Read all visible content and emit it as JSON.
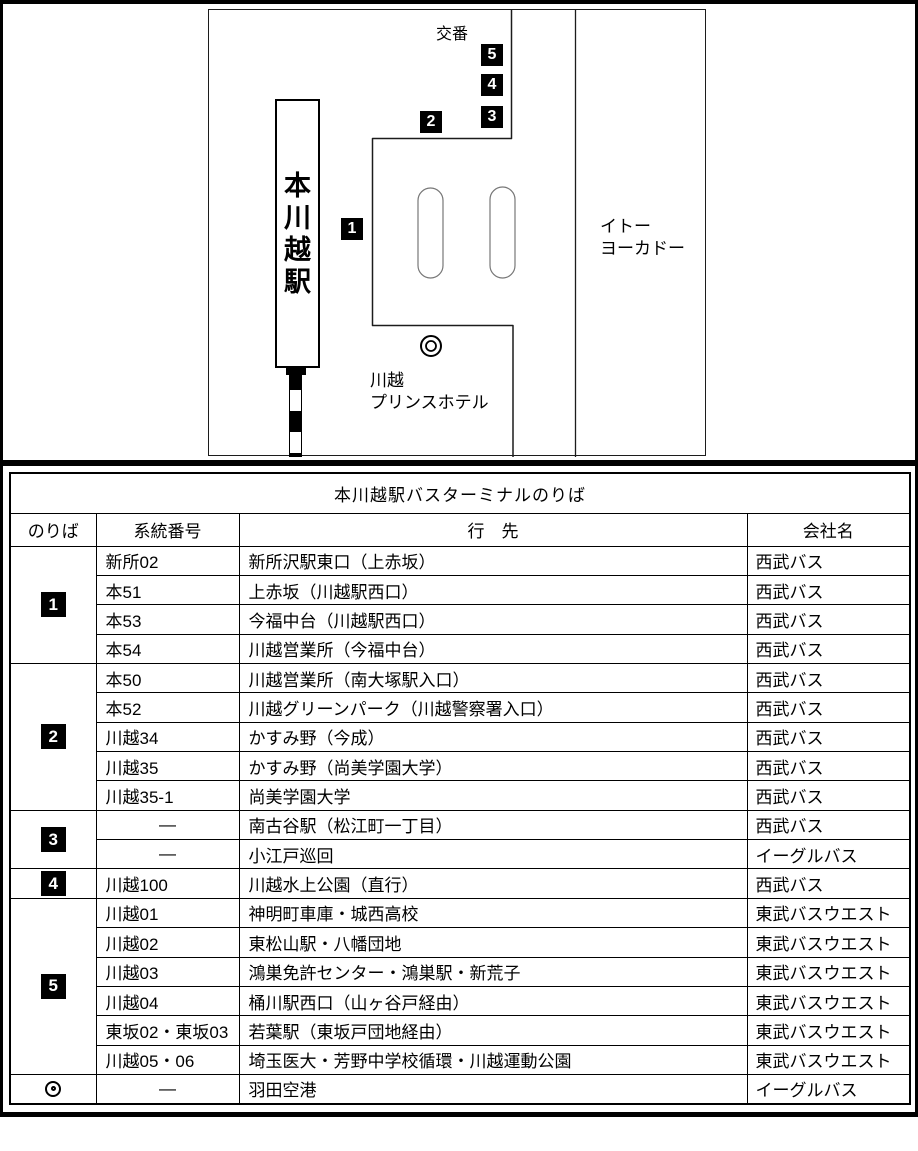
{
  "map": {
    "station": "本川越駅",
    "police_box": "交番",
    "store": [
      "イトー",
      "ヨーカドー"
    ],
    "hotel": [
      "川越",
      "プリンスホテル"
    ],
    "stop_markers": [
      "1",
      "2",
      "3",
      "4",
      "5"
    ]
  },
  "table": {
    "title": "本川越駅バスターミナルのりば",
    "headers": [
      "のりば",
      "系統番号",
      "行　先",
      "会社名"
    ],
    "groups": [
      {
        "platform": "1",
        "marker": "square",
        "rows": [
          {
            "route": "新所02",
            "destination": "新所沢駅東口（上赤坂）",
            "company": "西武バス"
          },
          {
            "route": "本51",
            "destination": "上赤坂（川越駅西口）",
            "company": "西武バス"
          },
          {
            "route": "本53",
            "destination": "今福中台（川越駅西口）",
            "company": "西武バス"
          },
          {
            "route": "本54",
            "destination": "川越営業所（今福中台）",
            "company": "西武バス"
          }
        ]
      },
      {
        "platform": "2",
        "marker": "square",
        "rows": [
          {
            "route": "本50",
            "destination": "川越営業所（南大塚駅入口）",
            "company": "西武バス"
          },
          {
            "route": "本52",
            "destination": "川越グリーンパーク（川越警察署入口）",
            "company": "西武バス"
          },
          {
            "route": "川越34",
            "destination": "かすみ野（今成）",
            "company": "西武バス"
          },
          {
            "route": "川越35",
            "destination": "かすみ野（尚美学園大学）",
            "company": "西武バス"
          },
          {
            "route": "川越35-1",
            "destination": "尚美学園大学",
            "company": "西武バス"
          }
        ]
      },
      {
        "platform": "3",
        "marker": "square",
        "rows": [
          {
            "route": "—",
            "destination": "南古谷駅（松江町一丁目）",
            "company": "西武バス"
          },
          {
            "route": "—",
            "destination": "小江戸巡回",
            "company": "イーグルバス"
          }
        ]
      },
      {
        "platform": "4",
        "marker": "square",
        "rows": [
          {
            "route": "川越100",
            "destination": "川越水上公園（直行）",
            "company": "西武バス"
          }
        ]
      },
      {
        "platform": "5",
        "marker": "square",
        "rows": [
          {
            "route": "川越01",
            "destination": "神明町車庫・城西高校",
            "company": "東武バスウエスト"
          },
          {
            "route": "川越02",
            "destination": "東松山駅・八幡団地",
            "company": "東武バスウエスト"
          },
          {
            "route": "川越03",
            "destination": "鴻巣免許センター・鴻巣駅・新荒子",
            "company": "東武バスウエスト"
          },
          {
            "route": "川越04",
            "destination": "桶川駅西口（山ヶ谷戸経由）",
            "company": "東武バスウエスト"
          },
          {
            "route": "東坂02・東坂03",
            "destination": "若葉駅（東坂戸団地経由）",
            "company": "東武バスウエスト"
          },
          {
            "route": "川越05・06",
            "destination": "埼玉医大・芳野中学校循環・川越運動公園",
            "company": "東武バスウエスト"
          }
        ]
      },
      {
        "platform": "◎",
        "marker": "double-circle",
        "rows": [
          {
            "route": "—",
            "destination": "羽田空港",
            "company": "イーグルバス"
          }
        ]
      }
    ]
  },
  "colors": {
    "ink": "#000000",
    "paper": "#ffffff"
  }
}
